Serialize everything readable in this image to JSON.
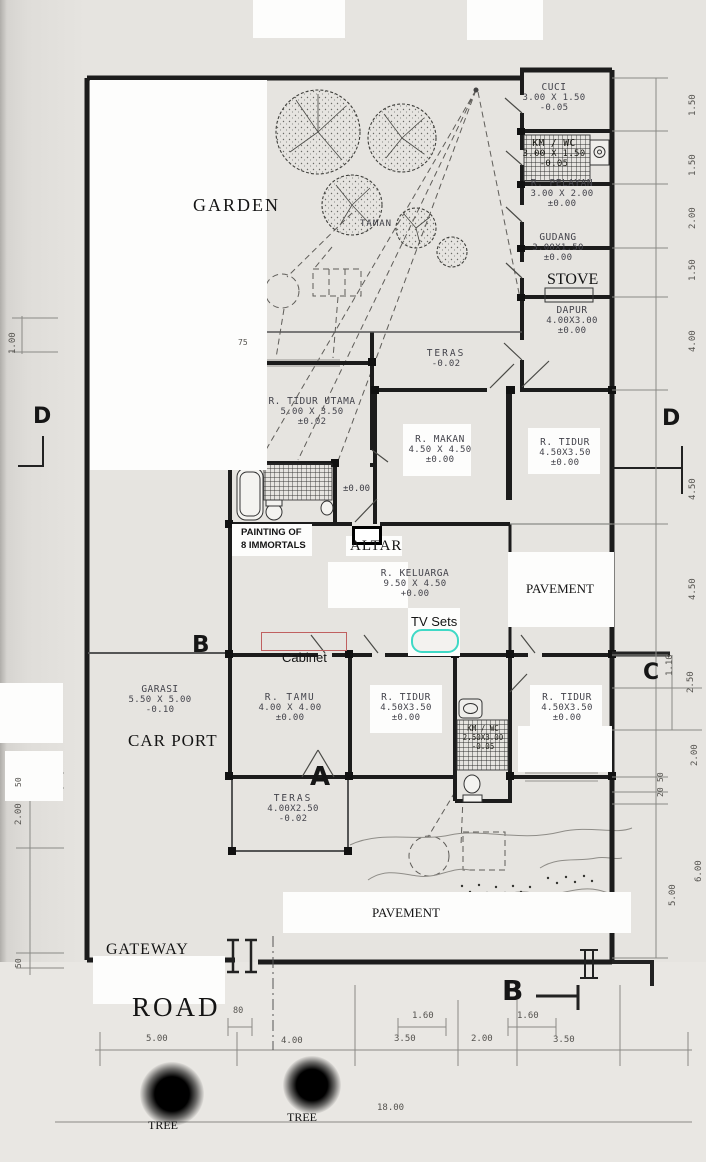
{
  "labels": {
    "garden": "GARDEN",
    "taman": "TAMAN",
    "stove": "STOVE",
    "altar": "ALTAR",
    "painting1": "PAINTING OF",
    "painting2": "8 IMMORTALS",
    "tv_sets": "TV Sets",
    "cabinet": "Cabinet",
    "car_port": "CAR PORT",
    "pavement_right": "PAVEMENT",
    "pavement_bottom": "PAVEMENT",
    "gateway": "GATEWAY",
    "road": "ROAD",
    "tree1": "TREE",
    "tree2": "TREE",
    "spot_level": "±0.00",
    "planter_dim": "75"
  },
  "rooms": [
    {
      "name": "CUCI",
      "size": "3.00 X 1.50",
      "level": "-0.05"
    },
    {
      "name": "KM / WC",
      "size": "3.00 X 1.50",
      "level": "-0.05"
    },
    {
      "name": "R. PELAYAN",
      "size": "3.00 X 2.00",
      "level": "±0.00"
    },
    {
      "name": "GUDANG",
      "size": "3.00X1.50",
      "level": "±0.00"
    },
    {
      "name": "DAPUR",
      "size": "4.00X3.00",
      "level": "±0.00"
    },
    {
      "name": "TERAS",
      "size": "",
      "level": "-0.02"
    },
    {
      "name": "R. TIDUR UTAMA",
      "size": "5.00 X 3.50",
      "level": "±0.02"
    },
    {
      "name": "R. MAKAN",
      "size": "4.50 X 4.50",
      "level": "±0.00"
    },
    {
      "name": "R. TIDUR",
      "size": "4.50X3.50",
      "level": "±0.00"
    },
    {
      "name": "R. KELUARGA",
      "size": "9.50 X 4.50",
      "level": "+0.00"
    },
    {
      "name": "GARASI",
      "size": "5.50 X 5.00",
      "level": "-0.10"
    },
    {
      "name": "R. TAMU",
      "size": "4.00 X 4.00",
      "level": "±0.00"
    },
    {
      "name": "R. TIDUR",
      "size": "4.50X3.50",
      "level": "±0.00"
    },
    {
      "name": "KM / WC",
      "size": "2.50X3.00",
      "level": "-0.05"
    },
    {
      "name": "R. TIDUR",
      "size": "4.50X3.50",
      "level": "±0.00"
    },
    {
      "name": "TERAS",
      "size": "4.00X2.50",
      "level": "-0.02"
    }
  ],
  "markers": {
    "d_left": "D",
    "d_right": "D",
    "b_left": "B",
    "c_right": "C",
    "a": "A",
    "b_bottom": "B"
  },
  "dims": {
    "right": [
      "1.50",
      "1.50",
      "2.00",
      "1.50",
      "4.00",
      "4.50",
      "4.50",
      "1.10",
      "2.50",
      "2.00",
      "50",
      "20",
      "6.00",
      "5.00"
    ],
    "left": [
      "1.00",
      "50",
      "2.00",
      "50"
    ],
    "bottom": [
      "80",
      "1.60",
      "1.60",
      "5.00",
      "4.00",
      "3.50",
      "2.00",
      "3.50",
      "18.00"
    ]
  },
  "colors": {
    "tv_outline": "#3fd9c6",
    "cabinet_outline": "#c06060",
    "wall": "#1c1c1c",
    "paper": "#e6e4e0"
  }
}
